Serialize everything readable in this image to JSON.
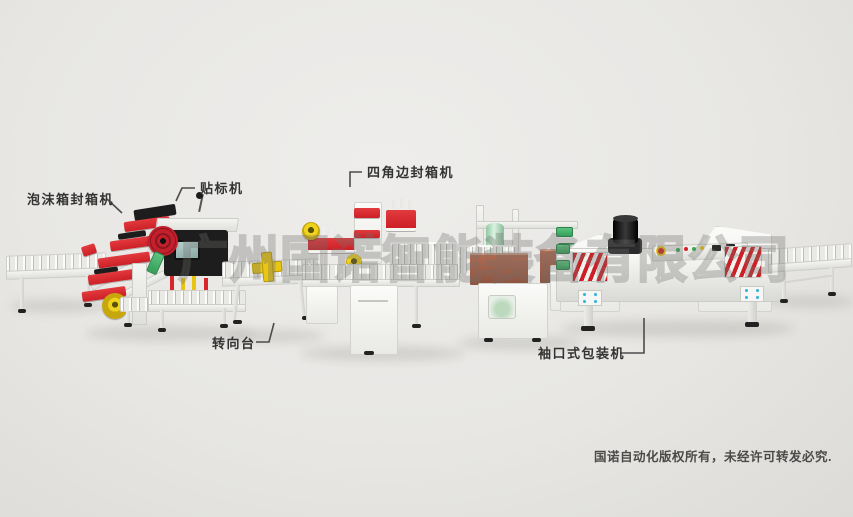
{
  "scene": {
    "watermark": "广州国诺智能装备有限公司",
    "copyright": "国诺自动化版权所有，未经许可转发必究.",
    "labels": {
      "foam_sealer": "泡沫箱封箱机",
      "labeler": "贴标机",
      "four_corner_sealer": "四角边封箱机",
      "turntable": "转向台",
      "sleeve_wrapper": "袖口式包装机"
    },
    "colors": {
      "background": "#e8e7e4",
      "machine_red": "#cc2026",
      "machine_yellow": "#e9c714",
      "machine_white": "#f4f4f1",
      "film_green": "#a8d8b6",
      "box_brown": "#9c5b43",
      "label_text": "#333333",
      "watermark_gray": "#707070"
    }
  }
}
